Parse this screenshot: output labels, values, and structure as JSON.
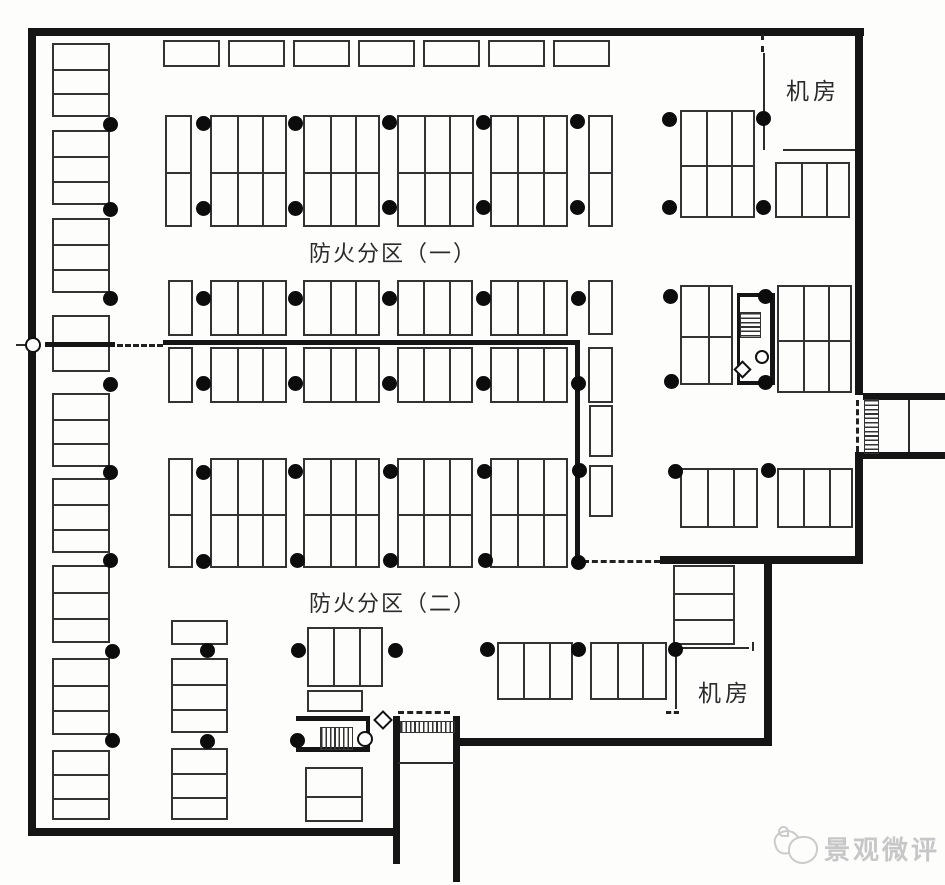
{
  "labels": {
    "zone1": "防火分区（一）",
    "zone2": "防火分区（二）",
    "machine_room_top": "机房",
    "machine_room_bottom": "机房",
    "watermark": "景观微评"
  },
  "colors": {
    "ink": "#151515",
    "line": "#333333",
    "paper": "#fdfdfc",
    "watermark": "#c7c7c7"
  },
  "plan": {
    "walls": [
      [
        28,
        28,
        836,
        8
      ],
      [
        28,
        28,
        8,
        808
      ],
      [
        28,
        828,
        372,
        8
      ],
      [
        855,
        28,
        8,
        367
      ],
      [
        855,
        452,
        8,
        112
      ],
      [
        660,
        556,
        203,
        8
      ],
      [
        764,
        556,
        8,
        190
      ],
      [
        456,
        738,
        316,
        8
      ],
      [
        393,
        716,
        7,
        148
      ],
      [
        453,
        716,
        7,
        166
      ],
      [
        863,
        393,
        82,
        7
      ],
      [
        863,
        452,
        82,
        7
      ],
      [
        163,
        340,
        414,
        5
      ],
      [
        575,
        340,
        5,
        226
      ],
      [
        45,
        342,
        70,
        5
      ],
      [
        737,
        293,
        38,
        4
      ],
      [
        737,
        381,
        38,
        4
      ],
      [
        737,
        293,
        3,
        92
      ],
      [
        770,
        293,
        5,
        92
      ],
      [
        296,
        716,
        74,
        5
      ],
      [
        296,
        747,
        74,
        5
      ],
      [
        366,
        716,
        4,
        36
      ]
    ],
    "thin_walls": [
      [
        763,
        53,
        2,
        97
      ],
      [
        783,
        149,
        72,
        2
      ],
      [
        675,
        647,
        74,
        2
      ],
      [
        675,
        649,
        2,
        60
      ],
      [
        752,
        642,
        2,
        9
      ],
      [
        908,
        400,
        2,
        52
      ],
      [
        398,
        762,
        57,
        2
      ],
      [
        16,
        344,
        13,
        2
      ]
    ],
    "dashes": [
      {
        "x": 117,
        "y": 344,
        "len": 46,
        "dir": "h"
      },
      {
        "x": 583,
        "y": 560,
        "len": 77,
        "dir": "h"
      },
      {
        "x": 761,
        "y": 34,
        "len": 18,
        "dir": "v"
      },
      {
        "x": 856,
        "y": 400,
        "len": 52,
        "dir": "v"
      },
      {
        "x": 398,
        "y": 711,
        "len": 52,
        "dir": "h"
      },
      {
        "x": 666,
        "y": 711,
        "len": 13,
        "dir": "h"
      }
    ],
    "stall_groups": [
      {
        "x": 163,
        "y": 40,
        "w": 57,
        "h": 27,
        "cols": 1,
        "rows": 1,
        "type": "v"
      },
      {
        "x": 228,
        "y": 40,
        "w": 57,
        "h": 27,
        "cols": 1,
        "rows": 1,
        "type": "v"
      },
      {
        "x": 293,
        "y": 40,
        "w": 57,
        "h": 27,
        "cols": 1,
        "rows": 1,
        "type": "v"
      },
      {
        "x": 358,
        "y": 40,
        "w": 57,
        "h": 27,
        "cols": 1,
        "rows": 1,
        "type": "v"
      },
      {
        "x": 423,
        "y": 40,
        "w": 57,
        "h": 27,
        "cols": 1,
        "rows": 1,
        "type": "v"
      },
      {
        "x": 488,
        "y": 40,
        "w": 57,
        "h": 27,
        "cols": 1,
        "rows": 1,
        "type": "v"
      },
      {
        "x": 553,
        "y": 40,
        "w": 57,
        "h": 27,
        "cols": 1,
        "rows": 1,
        "type": "v"
      },
      {
        "x": 165,
        "y": 115,
        "w": 27,
        "h": 112,
        "cols": 1,
        "rows": 2,
        "type": "v"
      },
      {
        "x": 210,
        "y": 115,
        "w": 77,
        "h": 112,
        "cols": 3,
        "rows": 2,
        "type": "v"
      },
      {
        "x": 303,
        "y": 115,
        "w": 77,
        "h": 112,
        "cols": 3,
        "rows": 2,
        "type": "v"
      },
      {
        "x": 397,
        "y": 115,
        "w": 77,
        "h": 112,
        "cols": 3,
        "rows": 2,
        "type": "v"
      },
      {
        "x": 490,
        "y": 115,
        "w": 78,
        "h": 112,
        "cols": 3,
        "rows": 2,
        "type": "v"
      },
      {
        "x": 588,
        "y": 115,
        "w": 25,
        "h": 112,
        "cols": 1,
        "rows": 2,
        "type": "v"
      },
      {
        "x": 680,
        "y": 110,
        "w": 75,
        "h": 108,
        "cols": 3,
        "rows": 2,
        "type": "v"
      },
      {
        "x": 775,
        "y": 162,
        "w": 75,
        "h": 56,
        "cols": 3,
        "rows": 1,
        "type": "v"
      },
      {
        "x": 168,
        "y": 280,
        "w": 25,
        "h": 56,
        "cols": 1,
        "rows": 1,
        "type": "v"
      },
      {
        "x": 210,
        "y": 280,
        "w": 77,
        "h": 56,
        "cols": 3,
        "rows": 1,
        "type": "v"
      },
      {
        "x": 303,
        "y": 280,
        "w": 77,
        "h": 56,
        "cols": 3,
        "rows": 1,
        "type": "v"
      },
      {
        "x": 397,
        "y": 280,
        "w": 76,
        "h": 56,
        "cols": 3,
        "rows": 1,
        "type": "v"
      },
      {
        "x": 490,
        "y": 280,
        "w": 78,
        "h": 56,
        "cols": 3,
        "rows": 1,
        "type": "v"
      },
      {
        "x": 588,
        "y": 280,
        "w": 25,
        "h": 55,
        "cols": 1,
        "rows": 1,
        "type": "v"
      },
      {
        "x": 168,
        "y": 347,
        "w": 25,
        "h": 56,
        "cols": 1,
        "rows": 1,
        "type": "v"
      },
      {
        "x": 210,
        "y": 347,
        "w": 77,
        "h": 56,
        "cols": 3,
        "rows": 1,
        "type": "v"
      },
      {
        "x": 303,
        "y": 347,
        "w": 77,
        "h": 56,
        "cols": 3,
        "rows": 1,
        "type": "v"
      },
      {
        "x": 397,
        "y": 347,
        "w": 76,
        "h": 56,
        "cols": 3,
        "rows": 1,
        "type": "v"
      },
      {
        "x": 490,
        "y": 347,
        "w": 78,
        "h": 56,
        "cols": 3,
        "rows": 1,
        "type": "v"
      },
      {
        "x": 588,
        "y": 347,
        "w": 25,
        "h": 56,
        "cols": 1,
        "rows": 1,
        "type": "v"
      },
      {
        "x": 680,
        "y": 285,
        "w": 53,
        "h": 100,
        "cols": 2,
        "rows": 2,
        "type": "v"
      },
      {
        "x": 777,
        "y": 285,
        "w": 75,
        "h": 108,
        "cols": 3,
        "rows": 2,
        "type": "v"
      },
      {
        "x": 589,
        "y": 405,
        "w": 24,
        "h": 52,
        "cols": 1,
        "rows": 1,
        "type": "v"
      },
      {
        "x": 589,
        "y": 465,
        "w": 24,
        "h": 52,
        "cols": 1,
        "rows": 1,
        "type": "v"
      },
      {
        "x": 168,
        "y": 458,
        "w": 25,
        "h": 110,
        "cols": 1,
        "rows": 2,
        "type": "v"
      },
      {
        "x": 210,
        "y": 458,
        "w": 77,
        "h": 110,
        "cols": 3,
        "rows": 2,
        "type": "v"
      },
      {
        "x": 303,
        "y": 458,
        "w": 77,
        "h": 110,
        "cols": 3,
        "rows": 2,
        "type": "v"
      },
      {
        "x": 397,
        "y": 458,
        "w": 76,
        "h": 110,
        "cols": 3,
        "rows": 2,
        "type": "v"
      },
      {
        "x": 490,
        "y": 458,
        "w": 78,
        "h": 110,
        "cols": 3,
        "rows": 2,
        "type": "v"
      },
      {
        "x": 680,
        "y": 468,
        "w": 78,
        "h": 60,
        "cols": 3,
        "rows": 1,
        "type": "v"
      },
      {
        "x": 777,
        "y": 468,
        "w": 76,
        "h": 60,
        "cols": 3,
        "rows": 1,
        "type": "v"
      },
      {
        "x": 307,
        "y": 627,
        "w": 76,
        "h": 60,
        "cols": 3,
        "rows": 1,
        "type": "v"
      },
      {
        "x": 307,
        "y": 690,
        "w": 56,
        "h": 22,
        "cols": 1,
        "rows": 1,
        "type": "v"
      },
      {
        "x": 497,
        "y": 642,
        "w": 76,
        "h": 58,
        "cols": 3,
        "rows": 1,
        "type": "v"
      },
      {
        "x": 590,
        "y": 642,
        "w": 77,
        "h": 58,
        "cols": 3,
        "rows": 1,
        "type": "v"
      },
      {
        "x": 673,
        "y": 565,
        "w": 62,
        "h": 80,
        "cols": 3,
        "rows": 1,
        "type": "h"
      },
      {
        "x": 305,
        "y": 767,
        "w": 58,
        "h": 55,
        "cols": 2,
        "rows": 1,
        "type": "h"
      },
      {
        "x": 52,
        "y": 43,
        "w": 58,
        "h": 74,
        "cols": 3,
        "rows": 1,
        "type": "h"
      },
      {
        "x": 52,
        "y": 130,
        "w": 58,
        "h": 75,
        "cols": 3,
        "rows": 1,
        "type": "h"
      },
      {
        "x": 52,
        "y": 218,
        "w": 58,
        "h": 75,
        "cols": 3,
        "rows": 1,
        "type": "h"
      },
      {
        "x": 52,
        "y": 315,
        "w": 58,
        "h": 57,
        "cols": 2,
        "rows": 1,
        "type": "h"
      },
      {
        "x": 52,
        "y": 393,
        "w": 58,
        "h": 74,
        "cols": 3,
        "rows": 1,
        "type": "h"
      },
      {
        "x": 52,
        "y": 478,
        "w": 58,
        "h": 75,
        "cols": 3,
        "rows": 1,
        "type": "h"
      },
      {
        "x": 52,
        "y": 565,
        "w": 58,
        "h": 78,
        "cols": 3,
        "rows": 1,
        "type": "h"
      },
      {
        "x": 52,
        "y": 658,
        "w": 58,
        "h": 77,
        "cols": 3,
        "rows": 1,
        "type": "h"
      },
      {
        "x": 52,
        "y": 750,
        "w": 58,
        "h": 70,
        "cols": 3,
        "rows": 1,
        "type": "h"
      },
      {
        "x": 171,
        "y": 620,
        "w": 57,
        "h": 25,
        "cols": 1,
        "rows": 1,
        "type": "h"
      },
      {
        "x": 171,
        "y": 658,
        "w": 57,
        "h": 75,
        "cols": 3,
        "rows": 1,
        "type": "h"
      },
      {
        "x": 171,
        "y": 748,
        "w": 57,
        "h": 72,
        "cols": 3,
        "rows": 1,
        "type": "h"
      }
    ],
    "dots": [
      [
        110,
        124
      ],
      [
        203,
        123
      ],
      [
        295,
        123
      ],
      [
        389,
        122
      ],
      [
        483,
        122
      ],
      [
        577,
        121
      ],
      [
        669,
        119
      ],
      [
        763,
        118
      ],
      [
        110,
        209
      ],
      [
        203,
        208
      ],
      [
        295,
        208
      ],
      [
        389,
        207
      ],
      [
        483,
        207
      ],
      [
        577,
        207
      ],
      [
        669,
        207
      ],
      [
        763,
        207
      ],
      [
        110,
        298
      ],
      [
        203,
        298
      ],
      [
        295,
        298
      ],
      [
        389,
        298
      ],
      [
        483,
        298
      ],
      [
        578,
        298
      ],
      [
        670,
        296
      ],
      [
        765,
        296
      ],
      [
        110,
        384
      ],
      [
        203,
        383
      ],
      [
        295,
        383
      ],
      [
        389,
        383
      ],
      [
        483,
        383
      ],
      [
        578,
        383
      ],
      [
        671,
        381
      ],
      [
        765,
        382
      ],
      [
        110,
        472
      ],
      [
        203,
        472
      ],
      [
        295,
        471
      ],
      [
        390,
        471
      ],
      [
        484,
        471
      ],
      [
        579,
        470
      ],
      [
        675,
        471
      ],
      [
        768,
        470
      ],
      [
        110,
        560
      ],
      [
        203,
        561
      ],
      [
        297,
        560
      ],
      [
        390,
        560
      ],
      [
        485,
        560
      ],
      [
        578,
        562
      ],
      [
        112,
        651
      ],
      [
        207,
        650
      ],
      [
        298,
        650
      ],
      [
        395,
        650
      ],
      [
        487,
        649
      ],
      [
        578,
        649
      ],
      [
        675,
        649
      ],
      [
        112,
        740
      ],
      [
        207,
        741
      ],
      [
        297,
        740
      ]
    ],
    "combs": [
      {
        "x": 740,
        "y": 312,
        "w": 19,
        "h": 24,
        "dir": "h"
      },
      {
        "x": 320,
        "y": 727,
        "w": 31,
        "h": 21,
        "dir": "v"
      },
      {
        "x": 400,
        "y": 721,
        "w": 53,
        "h": 10,
        "dir": "v"
      },
      {
        "x": 864,
        "y": 399,
        "w": 13,
        "h": 53,
        "dir": "h"
      }
    ],
    "circles": [
      {
        "cx": 33,
        "cy": 345,
        "r": 8
      },
      {
        "cx": 762,
        "cy": 357,
        "r": 7
      },
      {
        "cx": 365,
        "cy": 739,
        "r": 8
      }
    ],
    "diamonds": [
      {
        "cx": 742,
        "cy": 369,
        "s": 13
      },
      {
        "cx": 383,
        "cy": 720,
        "s": 14
      }
    ]
  }
}
